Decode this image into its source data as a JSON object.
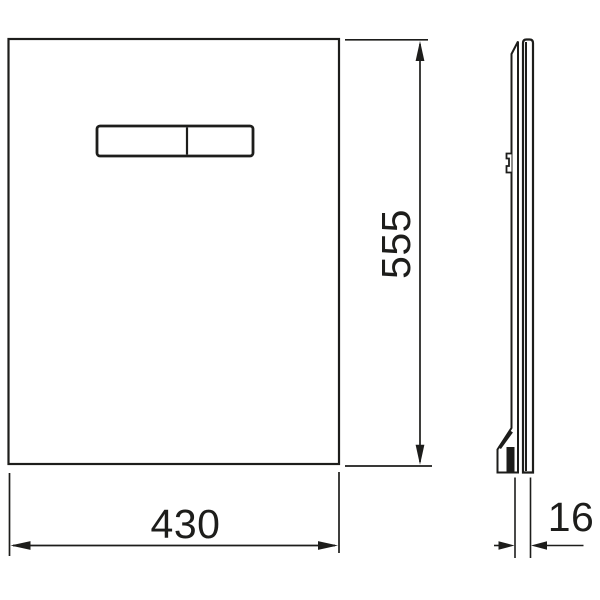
{
  "drawing": {
    "description": "flush-plate-dimension-drawing",
    "dimensions": {
      "width": "430",
      "height": "555",
      "depth": "16"
    },
    "colors": {
      "line": "#1d1d1b",
      "background": "#ffffff"
    }
  }
}
